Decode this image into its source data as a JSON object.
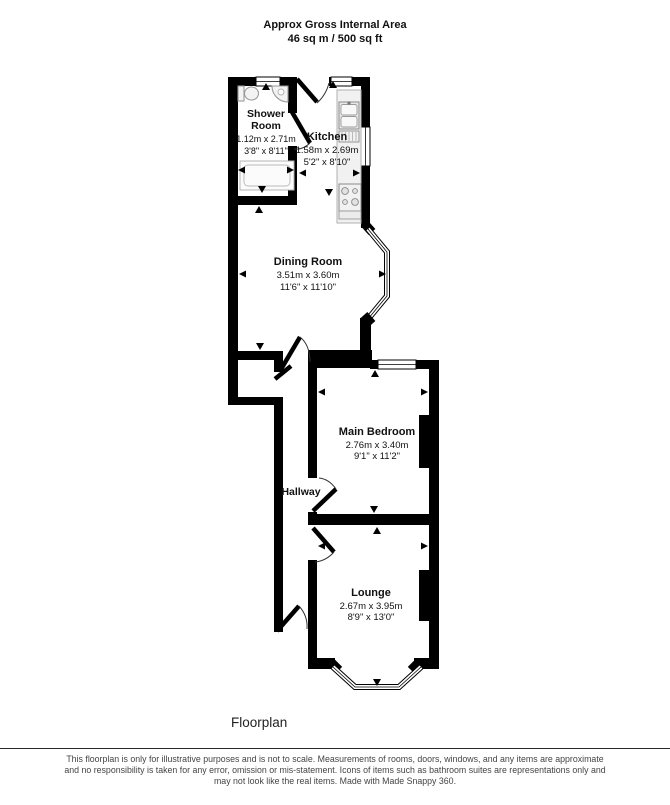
{
  "header": {
    "line1": "Approx Gross Internal Area",
    "line2": "46 sq m / 500 sq ft"
  },
  "rooms": [
    {
      "name": "Shower Room",
      "name_lines": [
        "Shower",
        "Room"
      ],
      "metric": "1.12m x 2.71m",
      "imperial": "3'8\" x 8'11\""
    },
    {
      "name": "Kitchen",
      "metric": "1.58m x 2.69m",
      "imperial": "5'2\" x 8'10\""
    },
    {
      "name": "Dining Room",
      "metric": "3.51m x 3.60m",
      "imperial": "11'6\" x 11'10\""
    },
    {
      "name": "Main Bedroom",
      "metric": "2.76m x 3.40m",
      "imperial": "9'1\" x 11'2\""
    },
    {
      "name": "Hallway"
    },
    {
      "name": "Lounge",
      "metric": "2.67m x 3.95m",
      "imperial": "8'9\" x 13'0\""
    }
  ],
  "footer": {
    "caption": "Floorplan"
  },
  "disclaimer": {
    "lines": [
      "This floorplan is only for illustrative purposes and is not to scale. Measurements of rooms, doors, windows, and any items are approximate",
      "and no responsibility is taken for any error, omission or mis-statement. Icons of items such as bathroom suites are representations only and",
      "may not look like the real items. Made with Made Snappy 360."
    ]
  },
  "colors": {
    "wall": "#000000",
    "label_text": "#111111",
    "disclaimer_text": "#444444",
    "fixture_stroke": "#999999"
  }
}
